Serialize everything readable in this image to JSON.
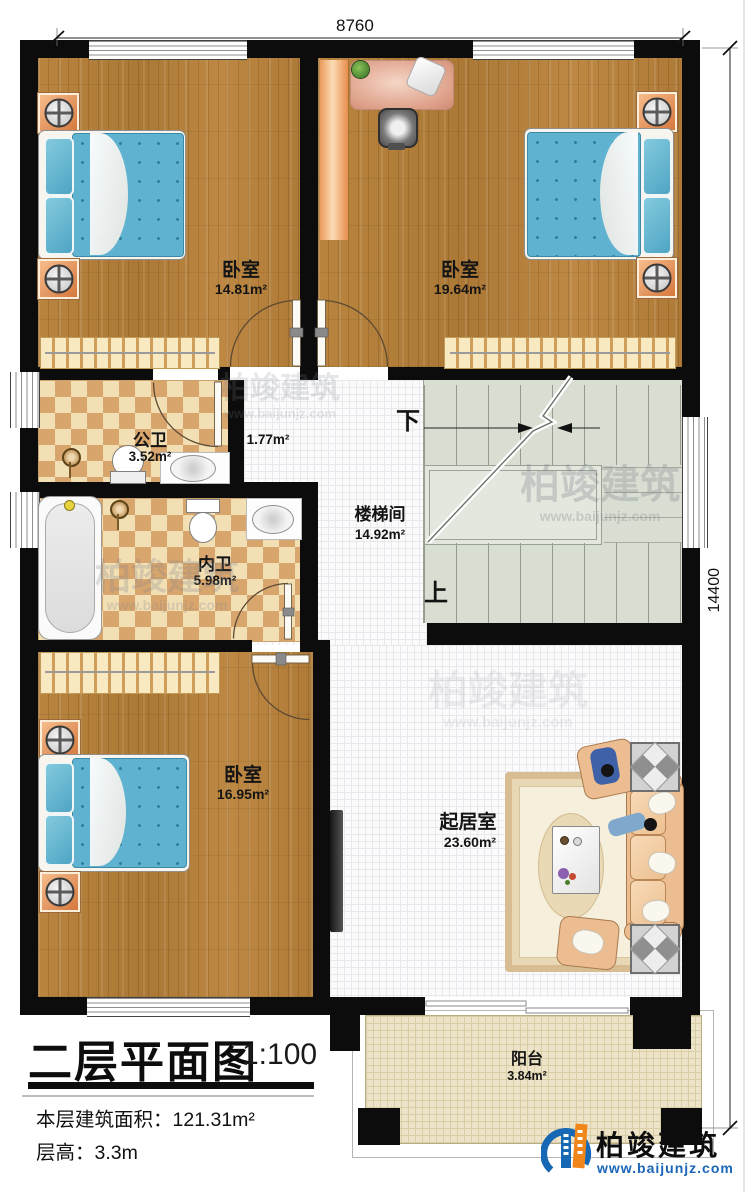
{
  "dimensions": {
    "width_mm": "8760",
    "height_mm": "14400"
  },
  "rooms": {
    "bedroom1": {
      "name": "卧室",
      "area": "14.81m²"
    },
    "bedroom2": {
      "name": "卧室",
      "area": "19.64m²"
    },
    "public_bath": {
      "name": "公卫",
      "area": "3.52m²"
    },
    "hallway": {
      "area": "1.77m²"
    },
    "inner_bath": {
      "name": "内卫",
      "area": "5.98m²"
    },
    "stairwell": {
      "name": "楼梯间",
      "area": "14.92m²"
    },
    "bedroom3": {
      "name": "卧室",
      "area": "16.95m²"
    },
    "living": {
      "name": "起居室",
      "area": "23.60m²"
    },
    "balcony": {
      "name": "阳台",
      "area": "3.84m²"
    }
  },
  "stairs": {
    "down": "下",
    "up": "上"
  },
  "title_block": {
    "title": "二层平面图",
    "scale": "1:100",
    "area_label": "本层建筑面积：",
    "area_value": "121.31m²",
    "height_label": "层高：",
    "height_value": "3.3m"
  },
  "brand": {
    "name": "柏竣建筑",
    "website": "www.baijunjz.com"
  },
  "watermark": {
    "name": "柏竣建筑",
    "website": "www.baijunjz.com"
  },
  "colors": {
    "wall": "#0c0c0c",
    "wood": "#b5813c",
    "tile_dark": "#d8a56d",
    "tile_light": "#f2dfb4",
    "stair": "#d9ded3",
    "balcony": "#ece3c8",
    "mattress": "#5fb3d0",
    "brand_blue": "#1668b5",
    "brand_orange": "#f08519"
  }
}
